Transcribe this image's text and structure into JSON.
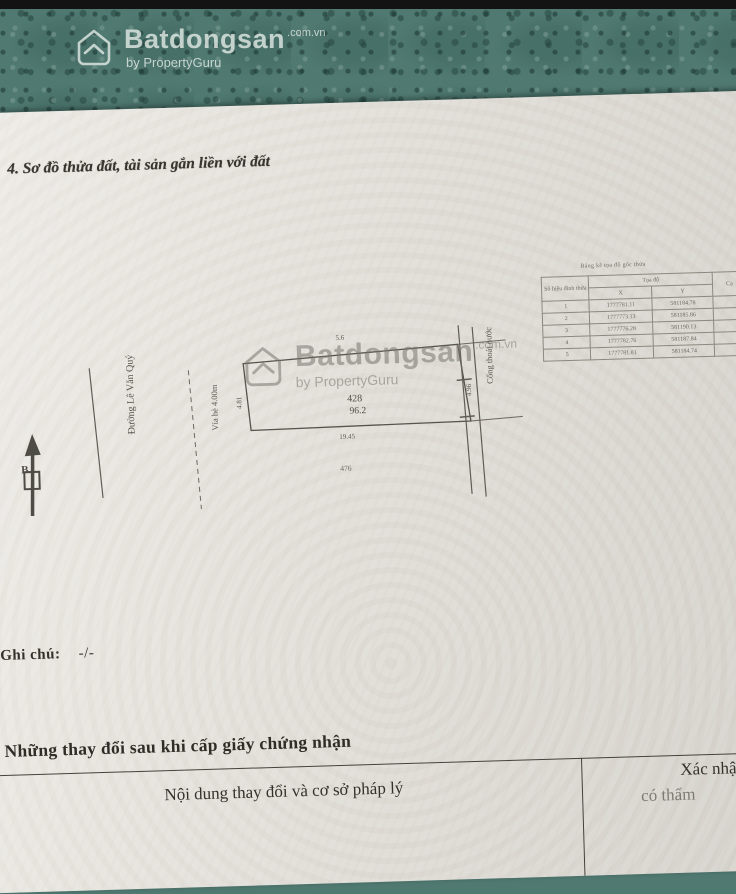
{
  "colors": {
    "teal_band": "#4f7971",
    "paper": "#e9e6e0",
    "ink": "#3b3a34",
    "watermark_top": "#e8eee9",
    "watermark_mid": "#76756e"
  },
  "watermark": {
    "brand": "Batdongsan",
    "suffix": ".com.vn",
    "byline": "by PropertyGuru"
  },
  "page": {
    "section4_title": "4. Sơ đồ thửa đất, tài sản gắn liền với đất",
    "note_label": ", Ghi chú:",
    "note_value": "-/-",
    "changes_title": "Những thay đổi sau khi cấp giấy chứng nhận",
    "changes_col1": "Nội dung thay đổi và cơ sở pháp lý",
    "changes_col2_line1": "Xác nhận c",
    "changes_col2_line2": "có thẩm"
  },
  "coord_table": {
    "caption": "Bảng kê tọa độ góc thửa",
    "col_vertex": "Số hiệu đỉnh thửa",
    "col_coords": "Tọa độ",
    "col_x": "X",
    "col_y": "Y",
    "col_edge": "Cạ",
    "rows": [
      {
        "n": "1",
        "x": "1777781.11",
        "y": "581184.78"
      },
      {
        "n": "2",
        "x": "1777773.13",
        "y": "581185.86"
      },
      {
        "n": "3",
        "x": "1777776.28",
        "y": "581190.13"
      },
      {
        "n": "4",
        "x": "1777782.76",
        "y": "581187.84"
      },
      {
        "n": "5",
        "x": "1777781.81",
        "y": "581184.74"
      }
    ]
  },
  "diagram": {
    "north_label": "B",
    "street_name": "Đường Lê Văn Quý",
    "sidewalk_label": "Vỉa hè 4.00m",
    "drain_label": "Cống thoát nước",
    "plot_number": "428",
    "plot_area": "96.2",
    "dim_top": "5.6",
    "dim_bottom": "19.45",
    "dim_left": "4.81",
    "dim_right": "4.96",
    "adjacent_plot": "476"
  }
}
